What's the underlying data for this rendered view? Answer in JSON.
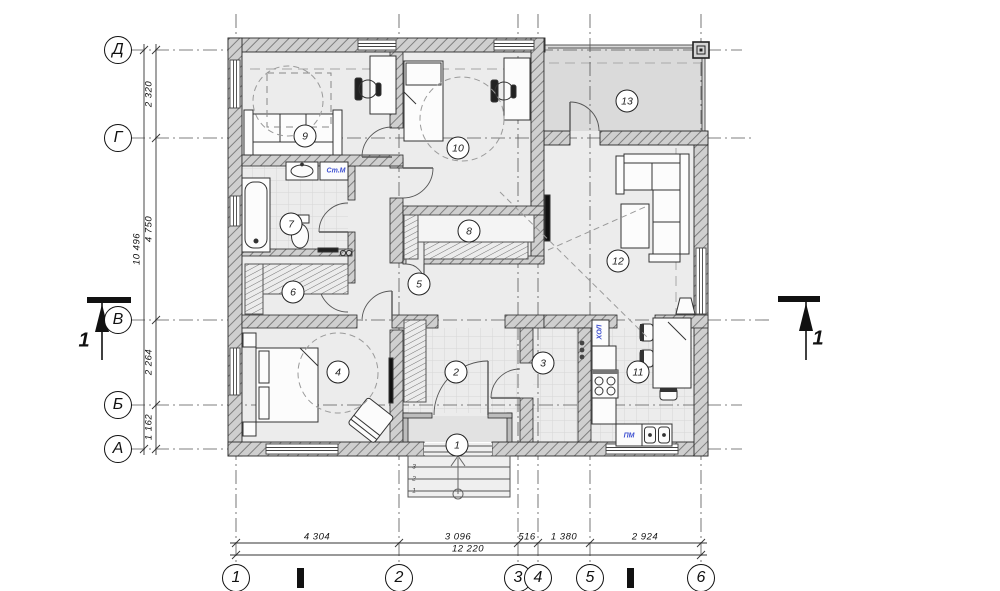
{
  "drawing_type": "floor-plan",
  "axes": {
    "horizontal": [
      {
        "label": "Д",
        "y": 50
      },
      {
        "label": "Г",
        "y": 138
      },
      {
        "label": "В",
        "y": 320
      },
      {
        "label": "Б",
        "y": 405
      },
      {
        "label": "А",
        "y": 449
      }
    ],
    "vertical": [
      {
        "label": "1",
        "x": 236
      },
      {
        "label": "2",
        "x": 399
      },
      {
        "label": "3",
        "x": 518
      },
      {
        "label": "4",
        "x": 538
      },
      {
        "label": "5",
        "x": 590
      },
      {
        "label": "6",
        "x": 701
      }
    ]
  },
  "dimensions": {
    "left_segments": [
      {
        "text": "2 320",
        "mid": 94
      },
      {
        "text": "4 750",
        "mid": 229
      },
      {
        "text": "2 264",
        "mid": 362
      },
      {
        "text": "1 162",
        "mid": 427
      }
    ],
    "left_total": {
      "text": "10 496",
      "mid": 249
    },
    "bottom_segments": [
      {
        "text": "4 304",
        "mid": 317
      },
      {
        "text": "3 096",
        "mid": 458
      },
      {
        "text": "516",
        "mid": 527
      },
      {
        "text": "1 380",
        "mid": 564
      },
      {
        "text": "2 924",
        "mid": 645
      }
    ],
    "bottom_total": {
      "text": "12 220",
      "mid": 468
    }
  },
  "rooms": [
    {
      "number": "1",
      "x": 457,
      "y": 445
    },
    {
      "number": "2",
      "x": 456,
      "y": 372
    },
    {
      "number": "3",
      "x": 543,
      "y": 363
    },
    {
      "number": "4",
      "x": 338,
      "y": 372
    },
    {
      "number": "5",
      "x": 419,
      "y": 284
    },
    {
      "number": "6",
      "x": 293,
      "y": 292
    },
    {
      "number": "7",
      "x": 291,
      "y": 224
    },
    {
      "number": "8",
      "x": 469,
      "y": 231
    },
    {
      "number": "9",
      "x": 305,
      "y": 136
    },
    {
      "number": "10",
      "x": 458,
      "y": 148
    },
    {
      "number": "11",
      "x": 638,
      "y": 372
    },
    {
      "number": "12",
      "x": 618,
      "y": 261
    },
    {
      "number": "13",
      "x": 627,
      "y": 101
    }
  ],
  "appliance_labels": [
    {
      "text": "Ст.М",
      "x": 336,
      "y": 171,
      "vertical": false
    },
    {
      "text": "ХОЛ",
      "x": 600,
      "y": 332,
      "vertical": true
    },
    {
      "text": "ПМ",
      "x": 629,
      "y": 436,
      "vertical": false
    }
  ],
  "step_labels": [
    {
      "text": "3",
      "x": 414,
      "y": 467
    },
    {
      "text": "2",
      "x": 414,
      "y": 479
    },
    {
      "text": "1",
      "x": 414,
      "y": 491
    }
  ],
  "section_markers": [
    {
      "label": "1",
      "x": 84,
      "y": 341
    },
    {
      "label": "1",
      "x": 818,
      "y": 339
    }
  ],
  "colors": {
    "room_fill": "#ececec",
    "terrace_fill": "#dadada",
    "wall_fill": "#cfcfcf",
    "line": "#222222",
    "blue_label": "#3d4fd0"
  }
}
